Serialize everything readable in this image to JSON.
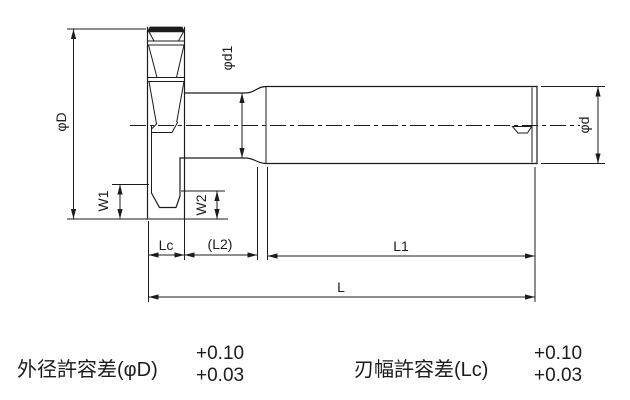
{
  "diagram": {
    "dimension_labels": {
      "phi_D": "φD",
      "phi_d1": "φd1",
      "phi_d": "φd",
      "W1": "W1",
      "W2": "W2",
      "Lc": "Lc",
      "L2": "(L2)",
      "L1": "L1",
      "L": "L"
    },
    "tolerance_notes": [
      {
        "label": "外径許容差(φD)",
        "upper": "+0.10",
        "lower": "+0.03"
      },
      {
        "label": "刃幅許容差(Lc)",
        "upper": "+0.10",
        "lower": "+0.03"
      }
    ],
    "colors": {
      "line": "#1c1c1c",
      "background": "#ffffff"
    }
  }
}
